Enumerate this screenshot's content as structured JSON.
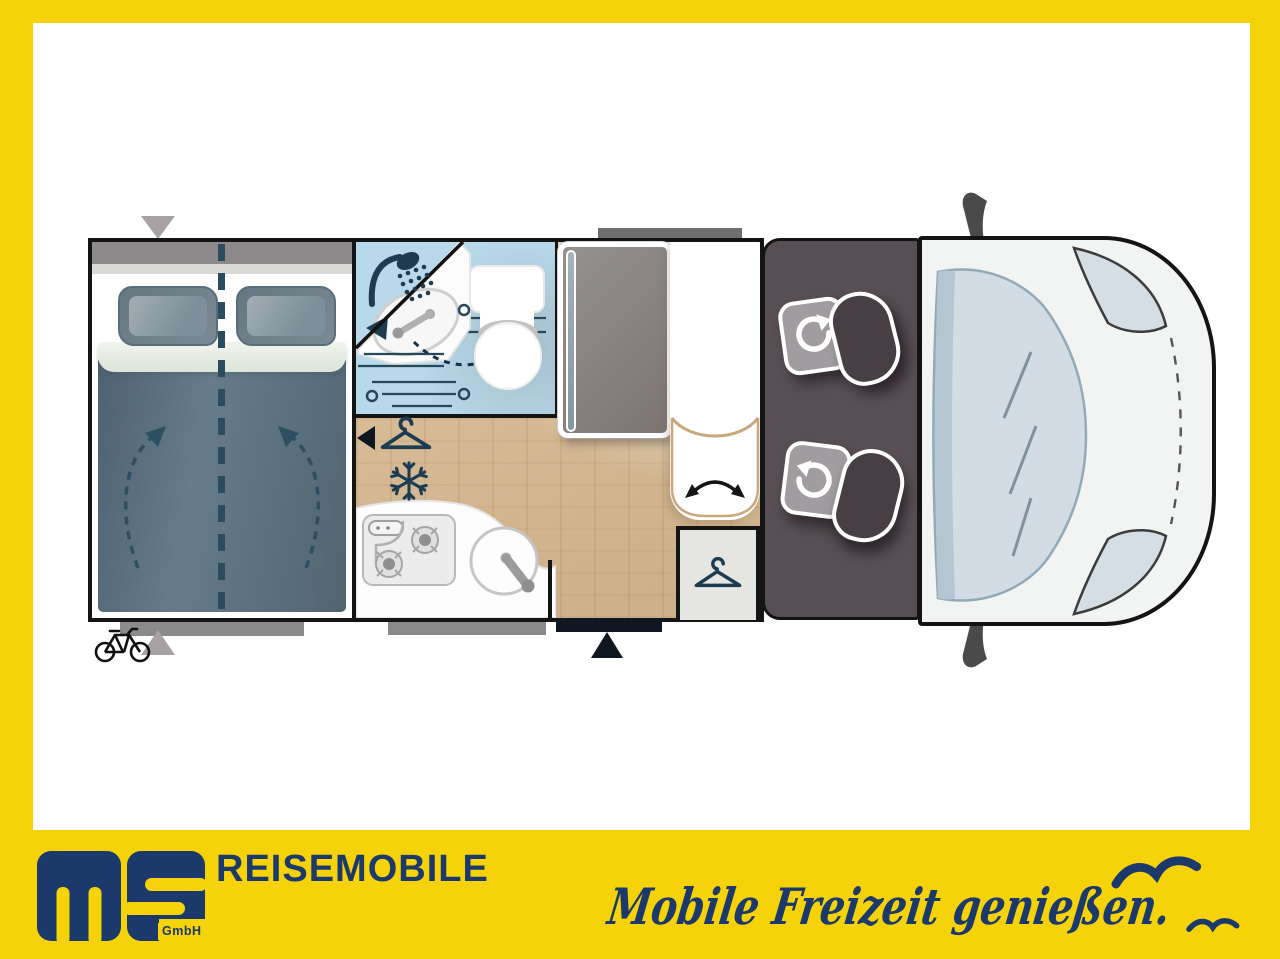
{
  "footer": {
    "logo_text": "ms",
    "logo_suffix": "GmbH",
    "brand": "REISEMOBILE",
    "slogan": "Mobile Freizeit genießen."
  },
  "palette": {
    "frame_yellow": "#F6D308",
    "brand_navy": "#1B3A6B",
    "plan_outline": "#141414",
    "icon_navy": "#1D3C52",
    "bathroom_blue": "#B7D9EA",
    "wood_floor": "#D9BD98",
    "cab_dark": "#584F54",
    "duvet_slate": "#5C7180"
  },
  "floorplan": {
    "zones": [
      {
        "id": "bedroom",
        "features": [
          "double-bed",
          "two-pillows",
          "center-split-dashed-line",
          "fold-up-dashed-arrows"
        ]
      },
      {
        "id": "bathroom",
        "features": [
          "shower-icon",
          "folding-washbasin",
          "swivel-dashed-arrow",
          "toilet"
        ]
      },
      {
        "id": "hallway",
        "features": [
          "wardrobe-hanger-icon",
          "left-arrow-marker",
          "fridge-snowflake-icon"
        ]
      },
      {
        "id": "kitchen",
        "features": [
          "two-burner-stove",
          "round-sink"
        ]
      },
      {
        "id": "dinette",
        "features": [
          "table",
          "bench-seat",
          "swivel-double-arrow"
        ]
      },
      {
        "id": "rear-wardrobe",
        "features": [
          "hanger-icon"
        ]
      },
      {
        "id": "cab",
        "features": [
          "driver-swivel-seat",
          "passenger-swivel-seat"
        ]
      },
      {
        "id": "vehicle-front",
        "features": [
          "windshield",
          "headlight-left",
          "headlight-right",
          "side-mirror-top",
          "side-mirror-bottom",
          "hood-dashed-line"
        ]
      }
    ],
    "markers": [
      "bike-rack-icon",
      "bed-width-triangle-top",
      "bed-width-triangle-bottom",
      "entry-door-triangle",
      "garage-door-bar-bed",
      "garage-door-bar-kitchen",
      "awning-bar-top",
      "entry-door-bar"
    ]
  }
}
